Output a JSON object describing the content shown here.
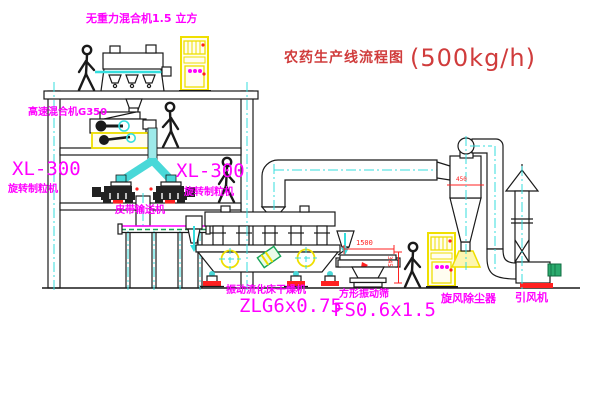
{
  "title": {
    "text": "农药生产线流程图",
    "capacity": "(500kg/h)"
  },
  "labels": {
    "gravity_mixer": "无重力混合机1.5 立方",
    "high_speed_mixer": "高速混合机G350",
    "granulator_left_model": "XL-300",
    "granulator_left_name": "旋转制粒机",
    "granulator_right_model": "XL-300",
    "granulator_right_name": "旋转制粒机",
    "belt_conveyor": "皮带输送机",
    "dryer_name": "振动流化床干燥机",
    "dryer_model": "ZLG6x0.75",
    "sieve_name": "方形振动筛",
    "sieve_model": "FS0.6x1.5",
    "cyclone": "旋风除尘器",
    "fan": "引风机"
  },
  "dimensions": {
    "sieve_width": "1500",
    "sieve_height": "345",
    "cyclone_inlet": "450"
  },
  "colors": {
    "label_magenta": "#ff00ff",
    "title_red": "#d03c3c",
    "line_black": "#1a1a1a",
    "highlight_yellow": "#efdf00",
    "centerline_cyan": "#35dede",
    "marker_red": "#ff2020",
    "belt_green": "#18a558"
  }
}
